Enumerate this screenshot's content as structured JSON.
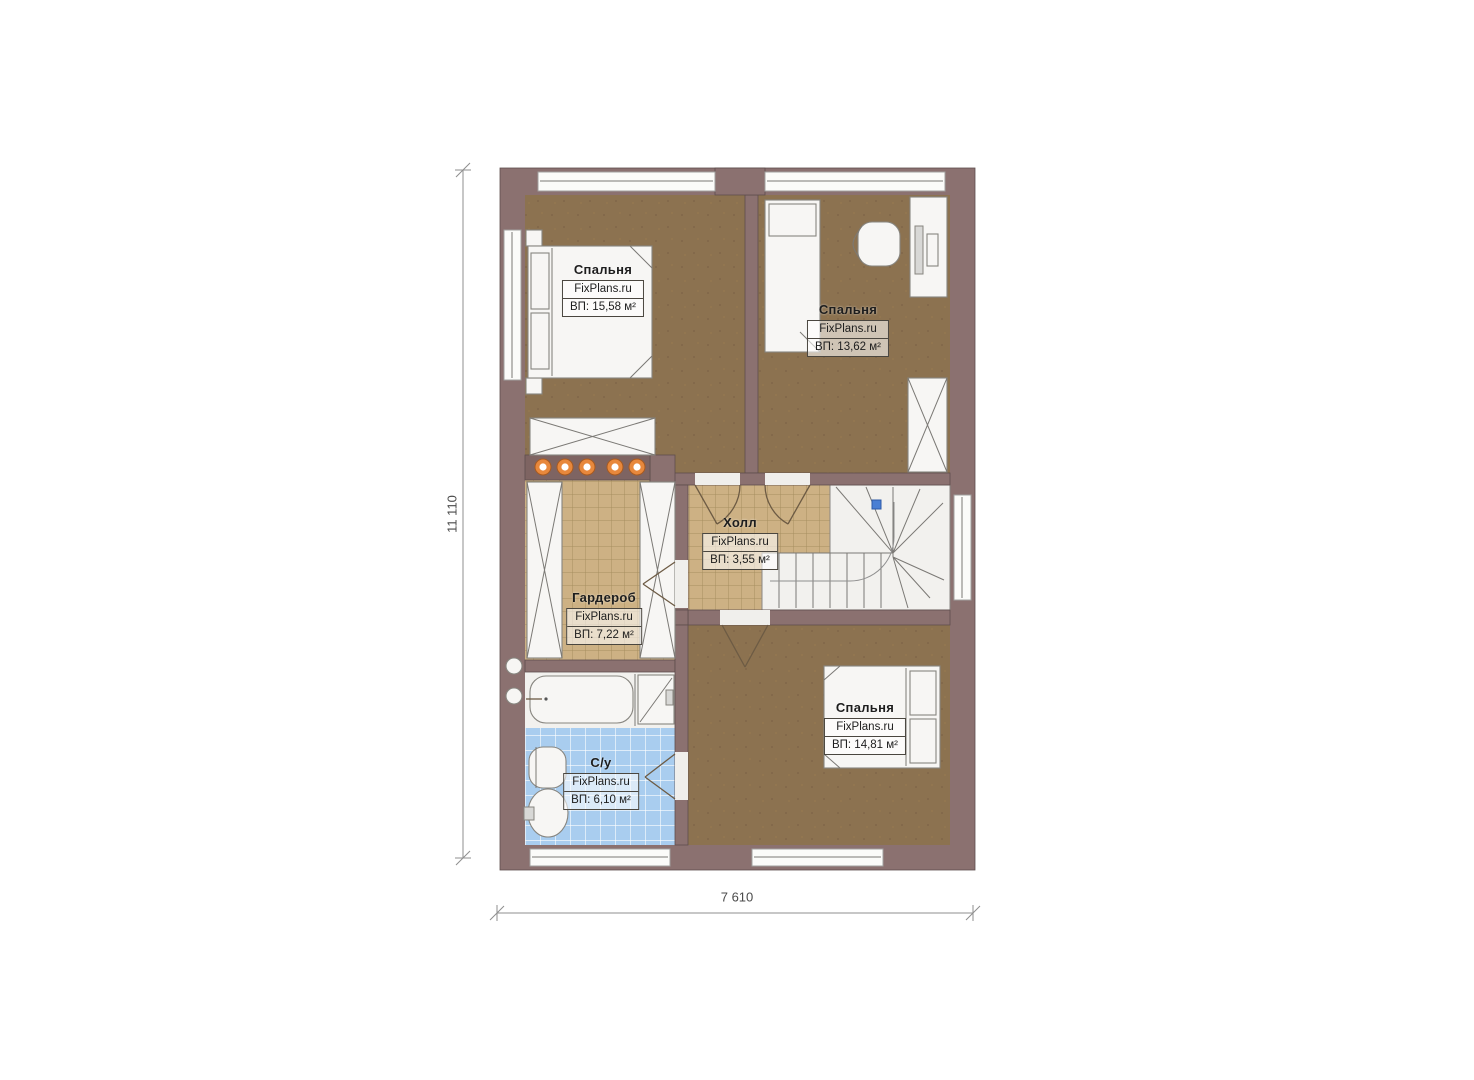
{
  "dimensions": {
    "height": "11 110",
    "width": "7 610"
  },
  "rooms": [
    {
      "id": "bedroom-1",
      "name": "Спальня",
      "brand": "FixPlans.ru",
      "area": "ВП: 15,58 м²"
    },
    {
      "id": "bedroom-2",
      "name": "Спальня",
      "brand": "FixPlans.ru",
      "area": "ВП: 13,62 м²"
    },
    {
      "id": "hall",
      "name": "Холл",
      "brand": "FixPlans.ru",
      "area": "ВП: 3,55 м²"
    },
    {
      "id": "wardrobe",
      "name": "Гардероб",
      "brand": "FixPlans.ru",
      "area": "ВП: 7,22 м²"
    },
    {
      "id": "bathroom",
      "name": "С/у",
      "brand": "FixPlans.ru",
      "area": "ВП: 6,10 м²"
    },
    {
      "id": "bedroom-3",
      "name": "Спальня",
      "brand": "FixPlans.ru",
      "area": "ВП: 14,81 м²"
    }
  ],
  "colors": {
    "wall": "#8b7170",
    "wood": "#8c7250",
    "tiletan": "#cdb184",
    "tilebath": "#a9cdef",
    "spotlight": "#e8883c",
    "marker": "#4a7fd4",
    "dim": "#4a4a4a",
    "bg": "#ffffff"
  }
}
